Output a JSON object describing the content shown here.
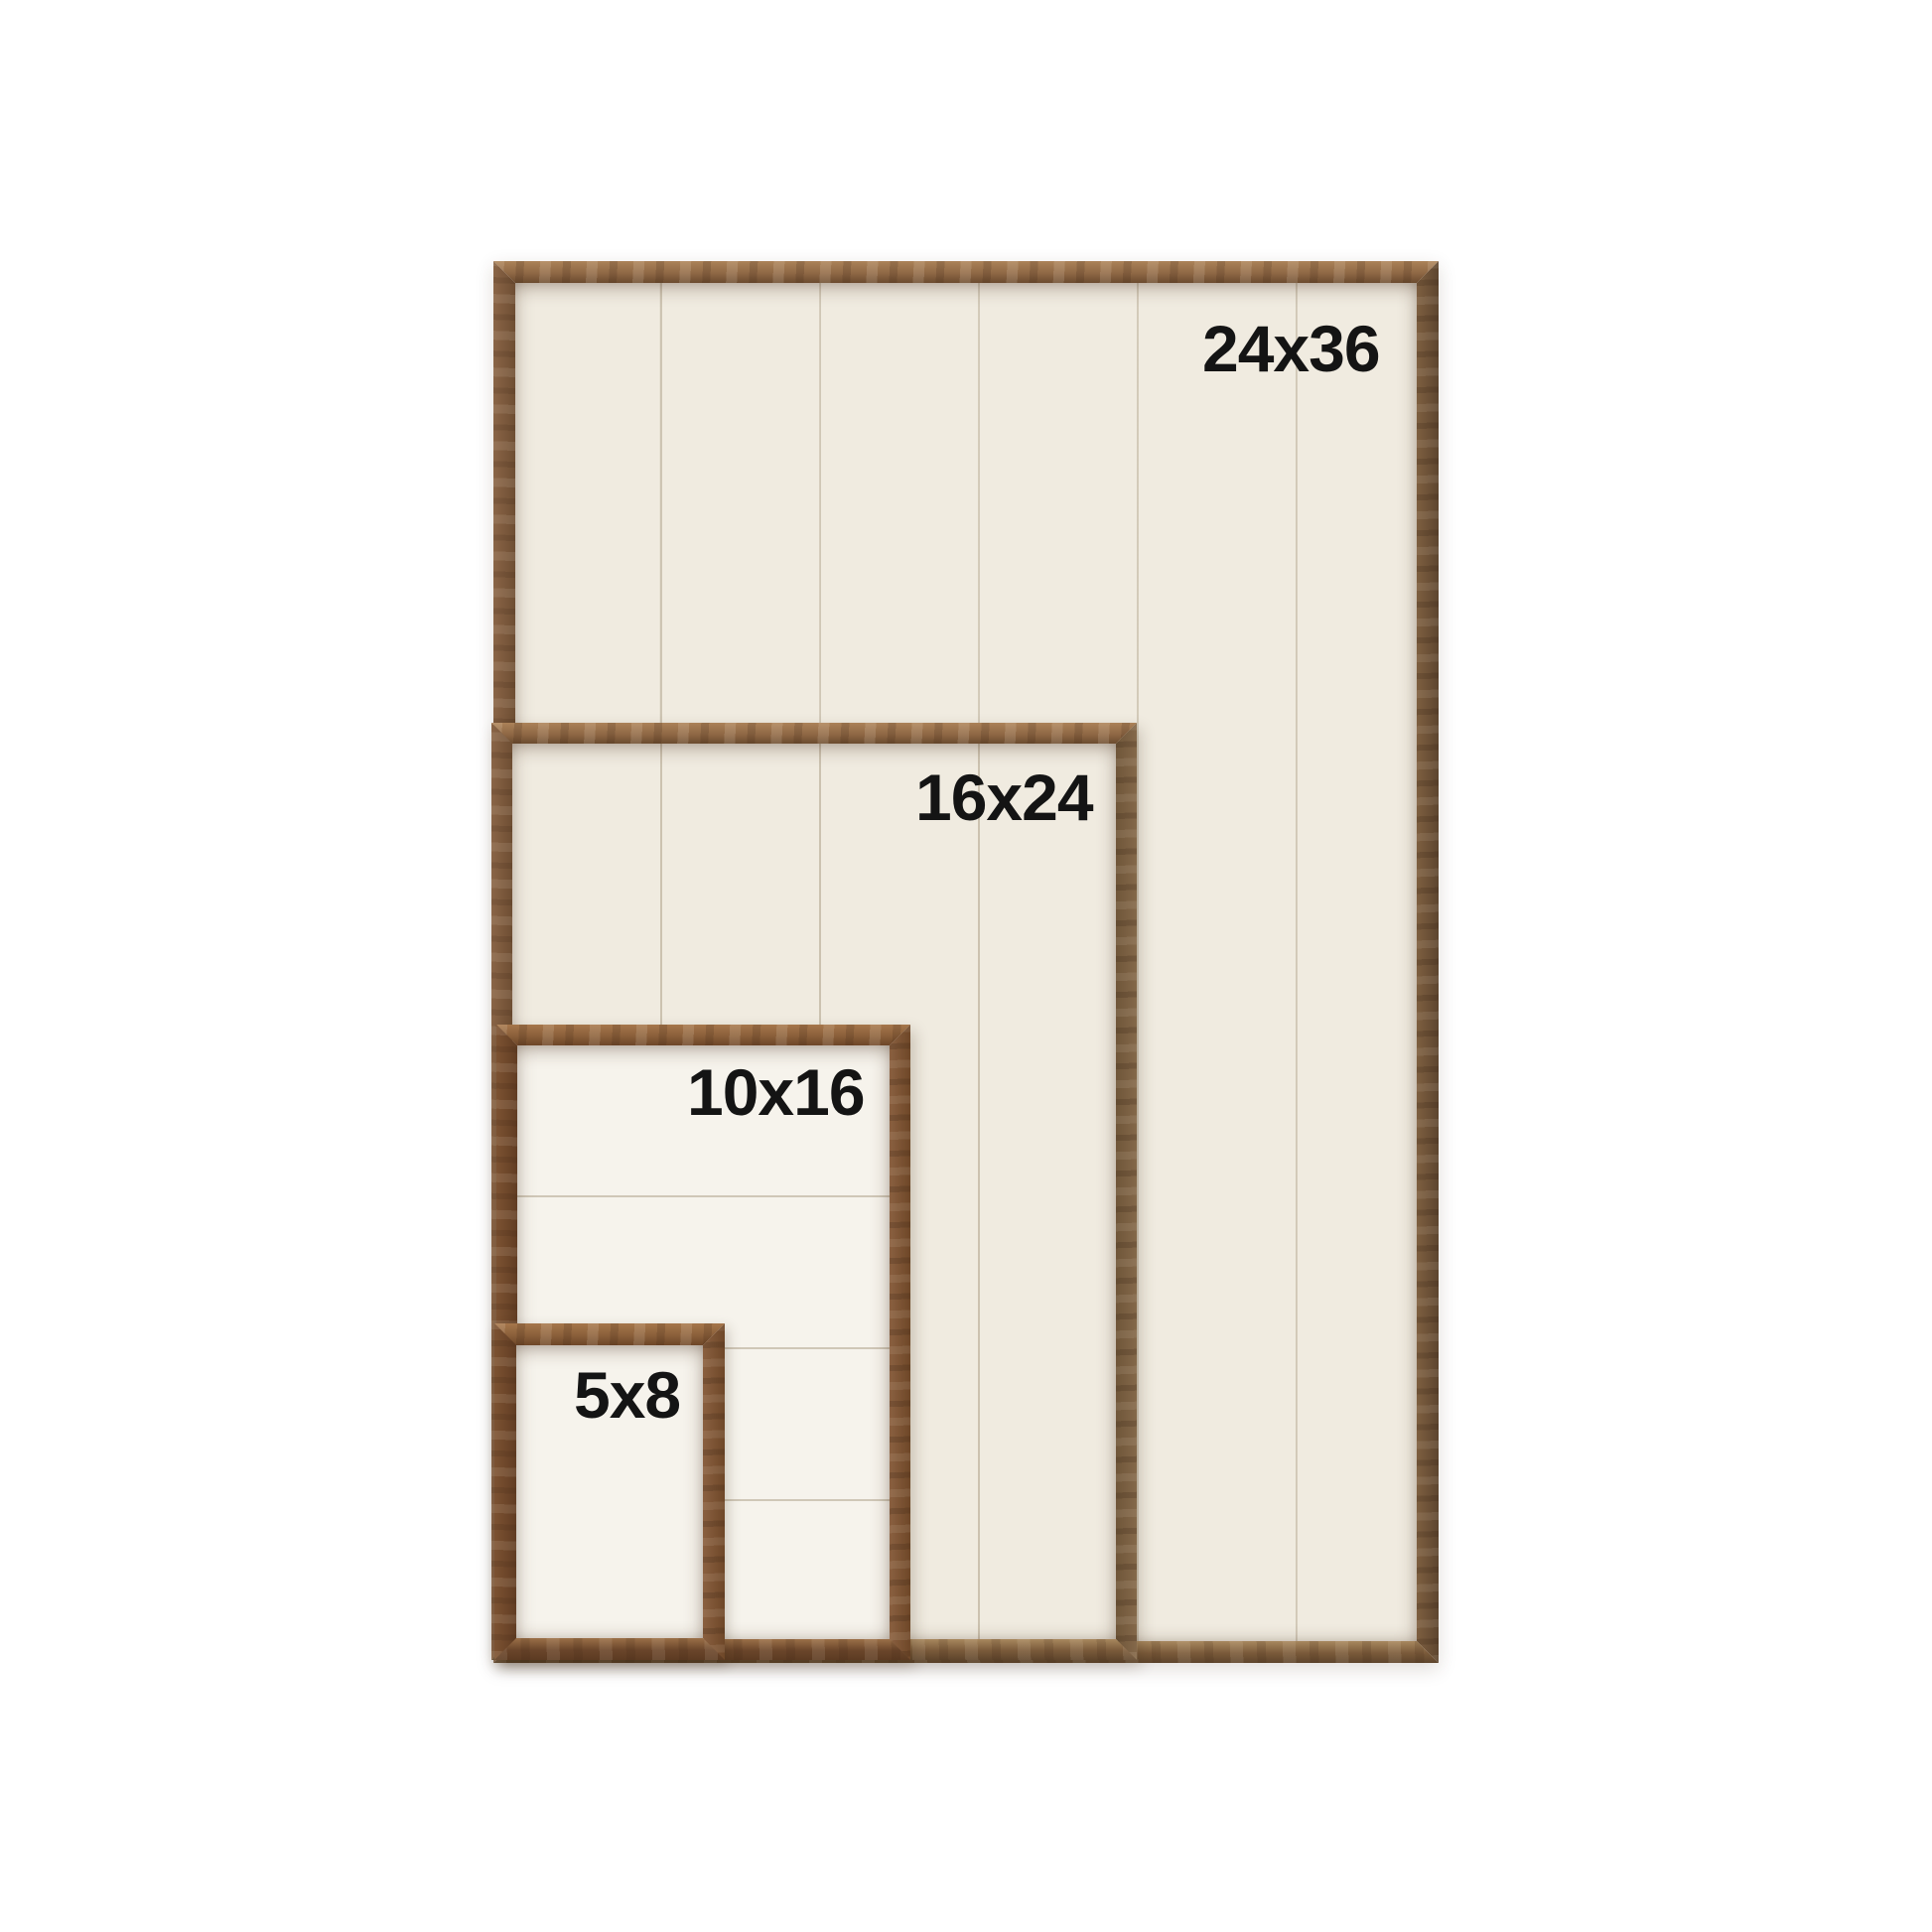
{
  "photo": {
    "description": "Wood framed sign size comparison chart with four nested frames",
    "sizes": [
      {
        "label": "24x36"
      },
      {
        "label": "16x24"
      },
      {
        "label": "10x16"
      },
      {
        "label": "5x8"
      }
    ]
  },
  "colors": {
    "page_bg": "#ffffff",
    "ink": "#141414",
    "panel_cream": "#f0ebe0",
    "panel_bright": "#f6f3ec",
    "walnut_top": "#8f6845",
    "walnut_top_hi": "#ab8258",
    "walnut_top_lo": "#6b4b2f",
    "walnut_left": "#8a6547",
    "walnut_left_lo": "#6e4e33",
    "walnut_right": "#5d452f",
    "walnut_right_hi": "#7e5f40",
    "walnut_right_soft": "#84684a",
    "walnut_right_soft_lo": "#6f5639",
    "walnut_bottom": "#7a5a3a",
    "walnut_bottom_hi": "#a8885e",
    "walnut_bottom_lo": "#5e452c",
    "chestnut_top": "#8a5f3a",
    "chestnut_top_hi": "#a5764b",
    "chestnut_top_lo": "#6d4628",
    "chestnut_left": "#7c5232",
    "chestnut_left_lo": "#613d23",
    "chestnut_right": "#6e4728",
    "chestnut_right_hi": "#8a6040",
    "chestnut_bottom": "#6a452a",
    "chestnut_bottom_hi": "#9b7048",
    "chestnut_bottom_lo": "#5c3b22"
  }
}
